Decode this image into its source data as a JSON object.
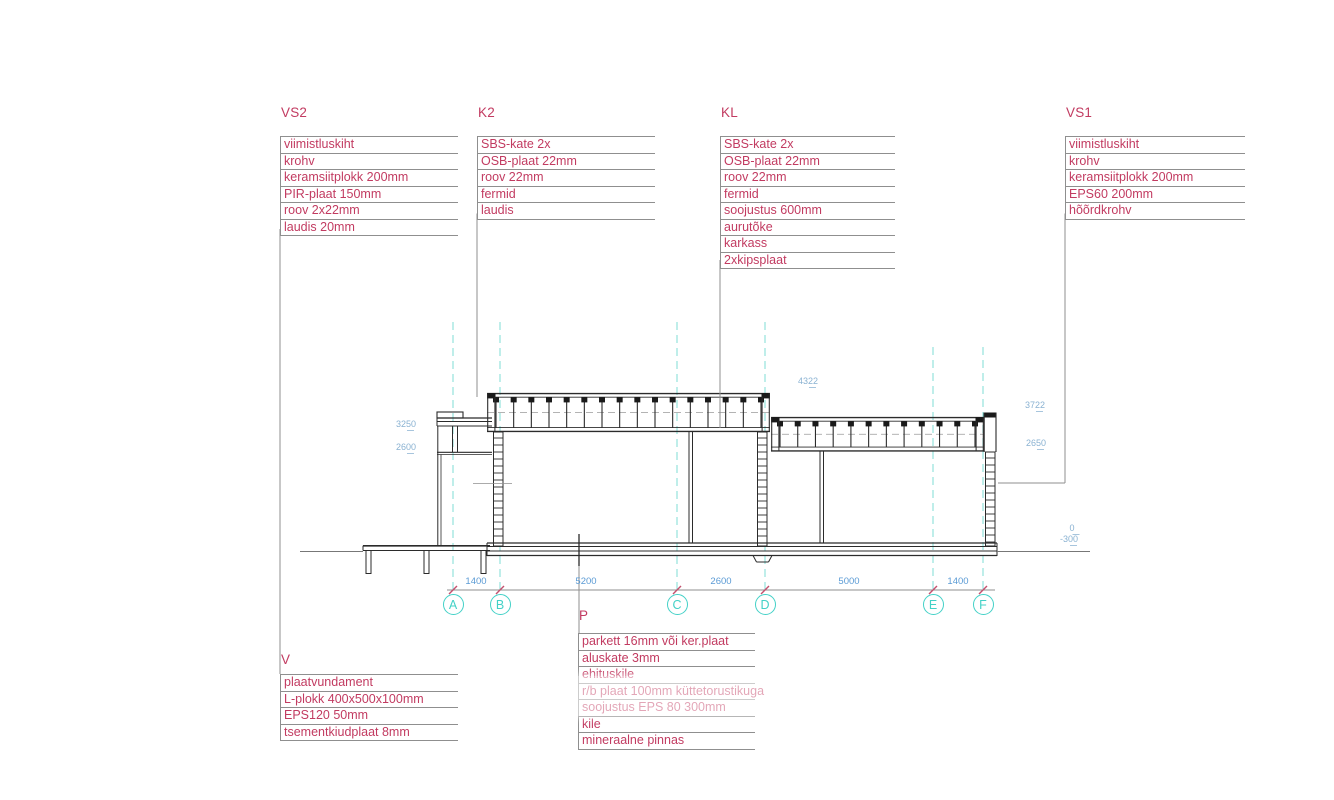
{
  "drawing": {
    "title_tags": {
      "wall_type_2": "VS2",
      "roof_type_2": "K2",
      "ceiling": "KL",
      "wall_type_1": "VS1",
      "foundation": "V",
      "floor": "P"
    },
    "spec_lists": [
      {
        "id": "vs2",
        "title": "VS2",
        "items": [
          "viimistluskiht",
          "krohv",
          "keramsiitplokk 200mm",
          "PIR-plaat 150mm",
          "roov 2x22mm",
          "laudis 20mm"
        ]
      },
      {
        "id": "k2",
        "title": "K2",
        "items": [
          "SBS-kate 2x",
          "OSB-plaat 22mm",
          "roov 22mm",
          "fermid",
          "laudis"
        ]
      },
      {
        "id": "kl",
        "title": "KL",
        "items": [
          "SBS-kate 2x",
          "OSB-plaat 22mm",
          "roov 22mm",
          "fermid",
          "soojustus 600mm",
          "aurutõke",
          "karkass",
          "2xkipsplaat"
        ]
      },
      {
        "id": "vs1",
        "title": "VS1",
        "items": [
          "viimistluskiht",
          "krohv",
          "keramsiitplokk 200mm",
          "EPS60 200mm",
          "hõõrdkrohv"
        ]
      },
      {
        "id": "v",
        "title": "V",
        "items": [
          "plaatvundament",
          "L-plokk 400x500x100mm",
          "EPS120 50mm",
          "tsementkiudplaat 8mm"
        ]
      },
      {
        "id": "p",
        "title": "P",
        "items": [
          "parkett 16mm või ker.plaat",
          "aluskate 3mm",
          "ehituskile",
          "r/b plaat 100mm küttetorustikuga",
          "soojustus EPS 80 300mm",
          "kile",
          "mineraalne pinnas"
        ]
      }
    ],
    "grid_axes": [
      {
        "label": "A",
        "x": 453,
        "y1": 322
      },
      {
        "label": "B",
        "x": 500,
        "y1": 322
      },
      {
        "label": "C",
        "x": 677,
        "y1": 322
      },
      {
        "label": "D",
        "x": 765,
        "y1": 322
      },
      {
        "label": "E",
        "x": 933,
        "y1": 347
      },
      {
        "label": "F",
        "x": 983,
        "y1": 347
      }
    ],
    "dimensions": [
      {
        "value": "1400",
        "x": 476
      },
      {
        "value": "5200",
        "x": 586
      },
      {
        "value": "2600",
        "x": 721
      },
      {
        "value": "5000",
        "x": 849
      },
      {
        "value": "1400",
        "x": 958
      }
    ],
    "levels": [
      {
        "value": "3250",
        "x": 406,
        "y": 420
      },
      {
        "value": "2600",
        "x": 406,
        "y": 443
      },
      {
        "value": "4322",
        "x": 808,
        "y": 377
      },
      {
        "value": "3722",
        "x": 1035,
        "y": 401
      },
      {
        "value": "2650",
        "x": 1036,
        "y": 439
      },
      {
        "value": "0",
        "x": 1072,
        "y": 524
      },
      {
        "value": "-300",
        "x": 1069,
        "y": 535
      }
    ],
    "colors": {
      "spec_text": "#c23b61",
      "line_gray": "#8f8f8f",
      "grid_cyan": "#43d1c7",
      "grid_cyan_light": "#7fdcd6",
      "dim_blue": "#5b9bd5",
      "level_blue": "#8ab2d2",
      "ink": "#2b2b2b",
      "tick_red": "#c4506e"
    }
  }
}
